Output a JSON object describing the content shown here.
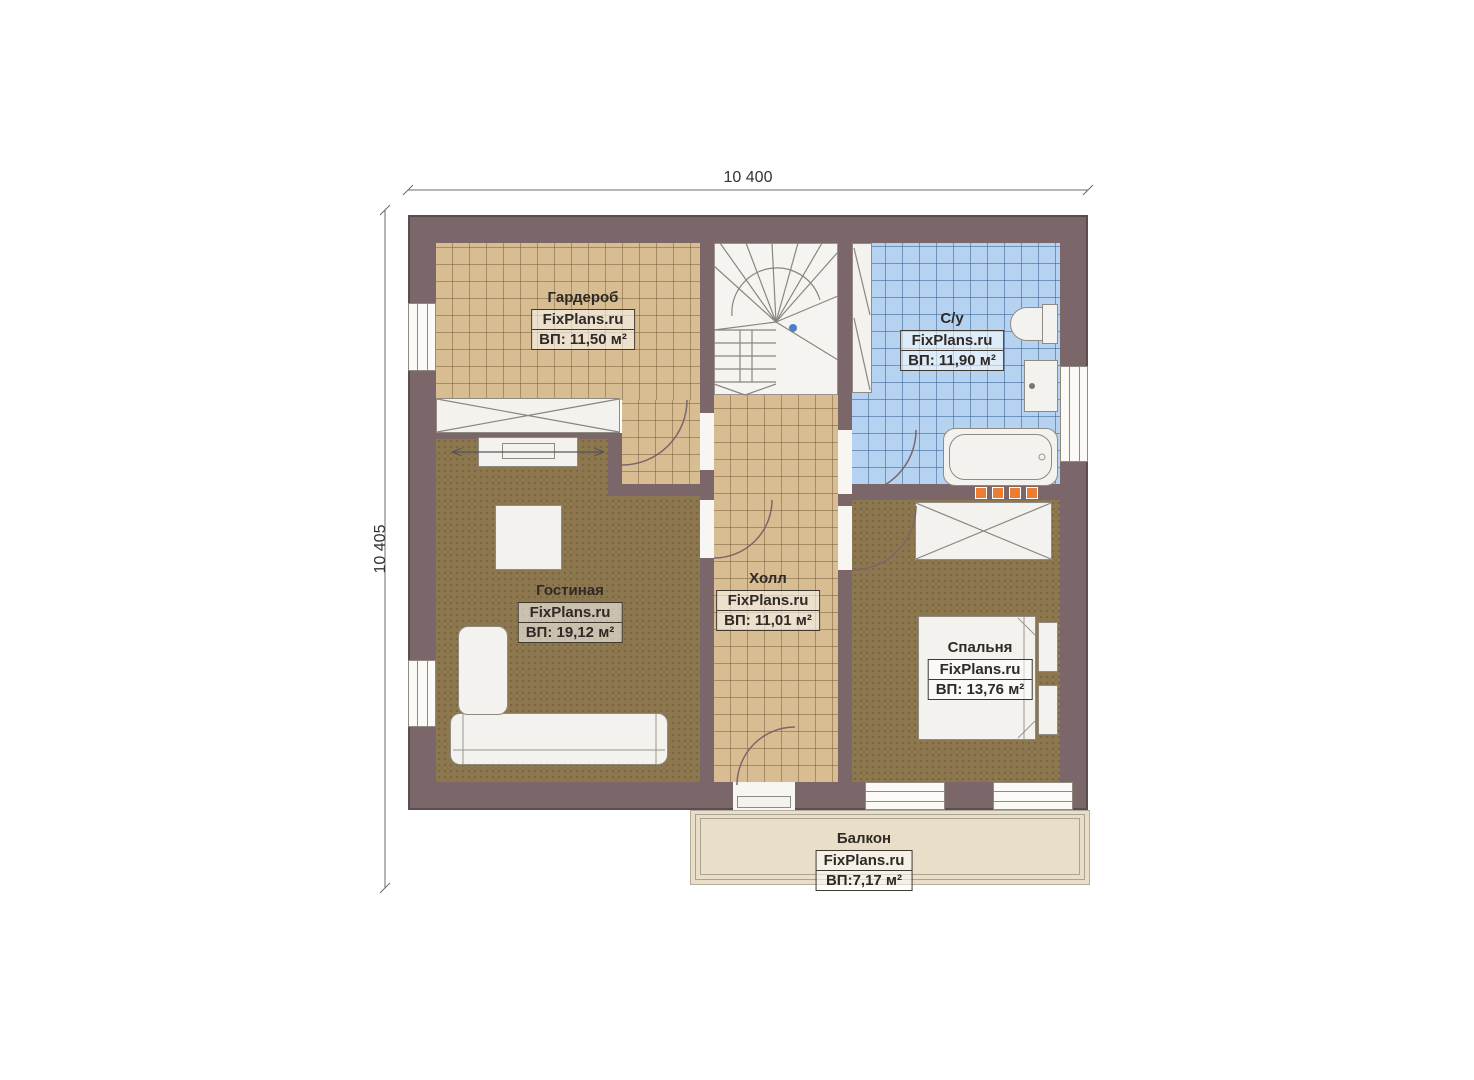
{
  "plan": {
    "dimensions": {
      "width_label": "10 400",
      "height_label": "10 405"
    },
    "rooms": [
      {
        "name": "Гардероб",
        "brand": "FixPlans.ru",
        "area": "ВП: 11,50 м²"
      },
      {
        "name": "С/у",
        "brand": "FixPlans.ru",
        "area": "ВП: 11,90 м²"
      },
      {
        "name": "Гостиная",
        "brand": "FixPlans.ru",
        "area": "ВП: 19,12 м²"
      },
      {
        "name": "Холл",
        "brand": "FixPlans.ru",
        "area": "ВП: 11,01 м²"
      },
      {
        "name": "Спальня",
        "brand": "FixPlans.ru",
        "area": "ВП: 13,76 м²"
      },
      {
        "name": "Балкон",
        "brand": "FixPlans.ru",
        "area": "ВП:7,17 м²"
      }
    ],
    "colors": {
      "wall": "#7b6669",
      "floor_tile_tan": "#d8bd92",
      "floor_tile_blue": "#b5d2f0",
      "floor_carpet_brown": "#8d774f",
      "floor_balcony": "#e9dfc9",
      "furniture": "#f3f2ee",
      "radiator_orange": "#ed7d31",
      "stair_marker_blue": "#4d7fc4"
    }
  }
}
